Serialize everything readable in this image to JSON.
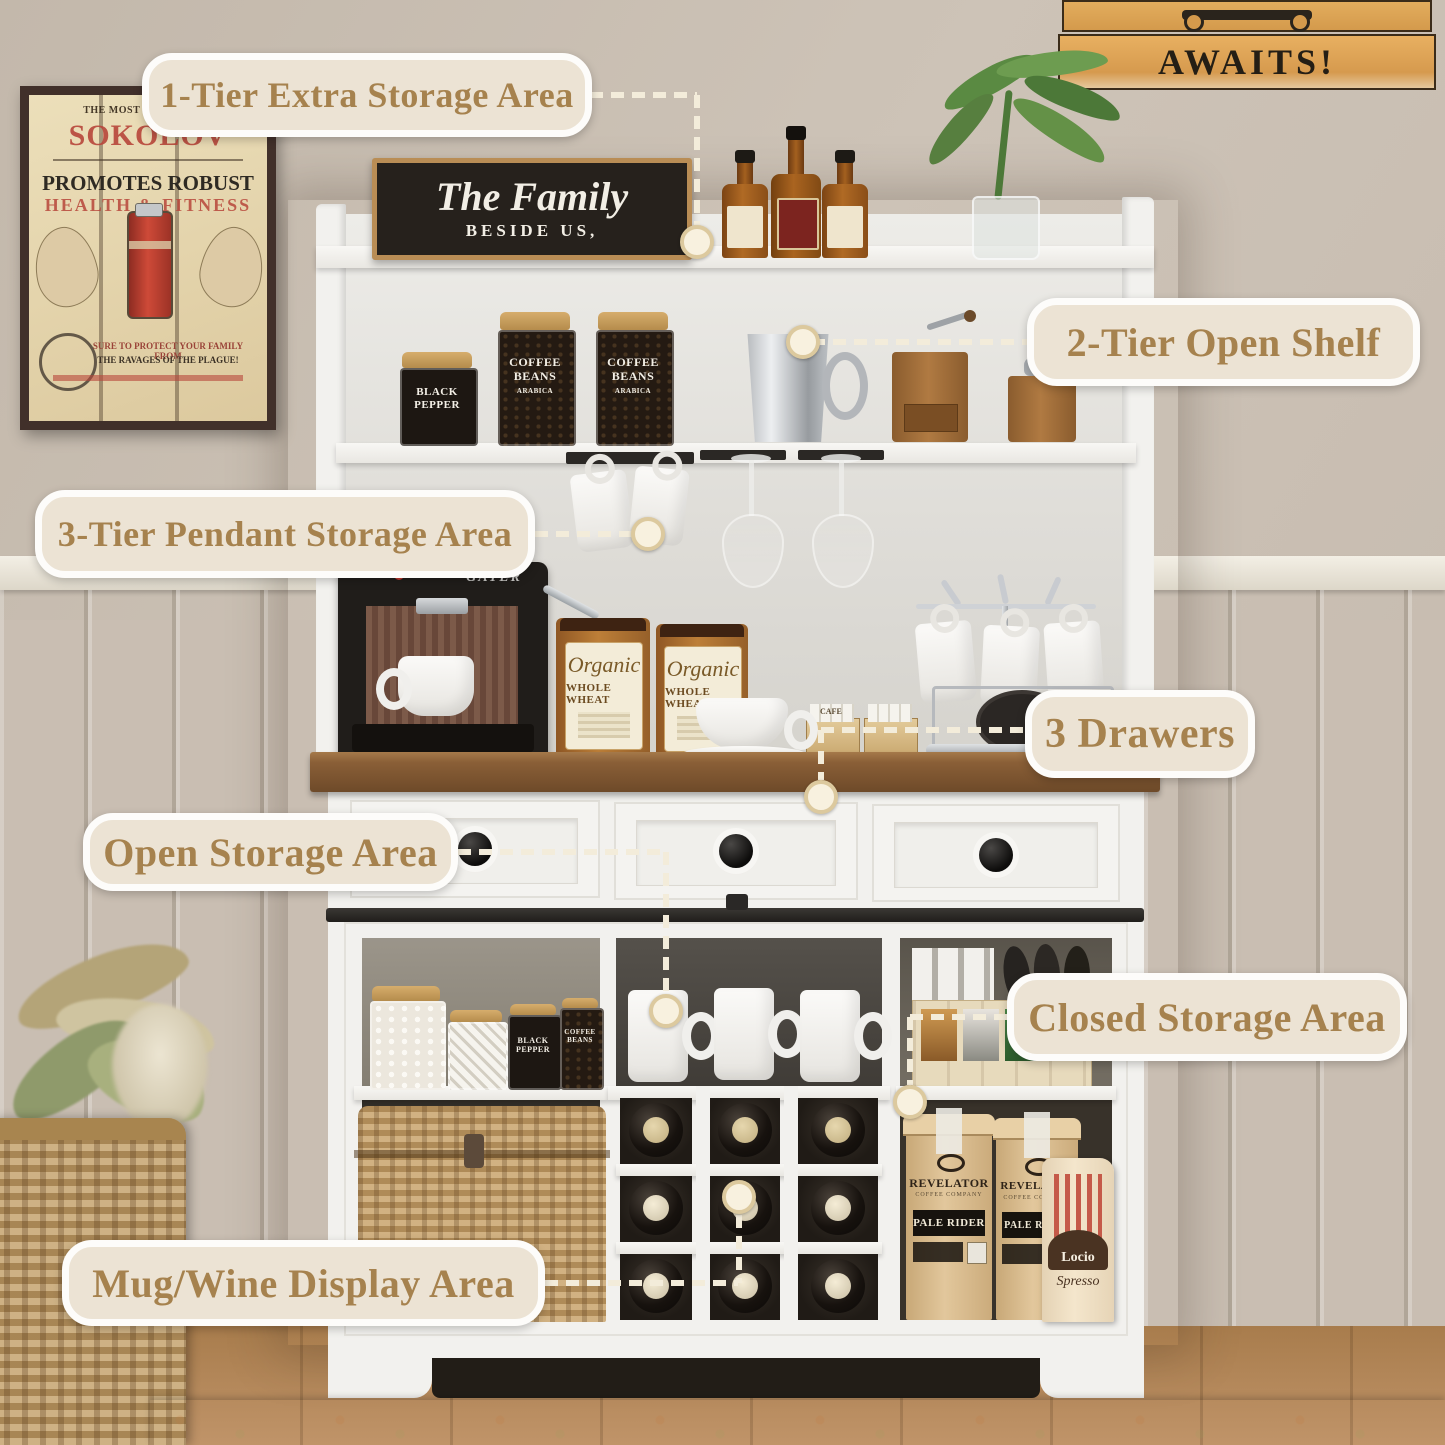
{
  "meta": {
    "description": "Annotated product photo of a white farmhouse coffee bar cabinet / buffet hutch with feature callouts"
  },
  "colors": {
    "pill_bg": "#ece3d4",
    "pill_border": "#fdfcfa",
    "pill_text": "#a6824e",
    "connector": "#f3ecda",
    "countertop": "#7a5330",
    "cabinet_white": "#f2f1ee",
    "wall": "#c9beb2",
    "wainscot": "#e9e4d9",
    "floor": "#b98c59"
  },
  "callouts": [
    {
      "label": "1-Tier Extra Storage Area",
      "pill": {
        "x": 142,
        "y": 53,
        "w": 450,
        "h": 84
      },
      "segs": [
        {
          "o": "h",
          "x": 590,
          "y": 95,
          "len": 107
        },
        {
          "o": "v",
          "x": 697,
          "y": 95,
          "len": 130
        }
      ],
      "end": {
        "x": 697,
        "y": 242
      }
    },
    {
      "label": "2-Tier Open Shelf",
      "pill": {
        "x": 1027,
        "y": 298,
        "w": 393,
        "h": 88
      },
      "segs": [
        {
          "o": "h",
          "x": 812,
          "y": 342,
          "len": 215
        }
      ],
      "end": {
        "x": 803,
        "y": 342
      }
    },
    {
      "label": "3-Tier Pendant Storage Area",
      "pill": {
        "x": 35,
        "y": 490,
        "w": 500,
        "h": 88
      },
      "segs": [
        {
          "o": "h",
          "x": 535,
          "y": 534,
          "len": 100
        }
      ],
      "end": {
        "x": 648,
        "y": 534
      }
    },
    {
      "label": "3 Drawers",
      "pill": {
        "x": 1025,
        "y": 690,
        "w": 230,
        "h": 88
      },
      "segs": [
        {
          "o": "h",
          "x": 821,
          "y": 730,
          "len": 204
        },
        {
          "o": "v",
          "x": 821,
          "y": 730,
          "len": 50
        }
      ],
      "end": {
        "x": 821,
        "y": 797
      }
    },
    {
      "label": "Open Storage Area",
      "pill": {
        "x": 83,
        "y": 813,
        "w": 375,
        "h": 78
      },
      "segs": [
        {
          "o": "h",
          "x": 458,
          "y": 852,
          "len": 207
        },
        {
          "o": "v",
          "x": 666,
          "y": 852,
          "len": 142
        }
      ],
      "end": {
        "x": 666,
        "y": 1011
      }
    },
    {
      "label": "Closed Storage Area",
      "pill": {
        "x": 1007,
        "y": 973,
        "w": 400,
        "h": 88
      },
      "segs": [
        {
          "o": "h",
          "x": 910,
          "y": 1017,
          "len": 97
        },
        {
          "o": "v",
          "x": 910,
          "y": 1017,
          "len": 68
        }
      ],
      "end": {
        "x": 910,
        "y": 1102
      }
    },
    {
      "label": "Mug/Wine Display Area",
      "pill": {
        "x": 62,
        "y": 1240,
        "w": 483,
        "h": 86
      },
      "segs": [
        {
          "o": "h",
          "x": 545,
          "y": 1283,
          "len": 193
        },
        {
          "o": "v",
          "x": 739,
          "y": 1215,
          "len": 68
        }
      ],
      "end": {
        "x": 739,
        "y": 1197
      }
    }
  ],
  "wall": {
    "poster": {
      "top_line": "THE MOST POPULAR FO",
      "brand": "SOKOLOV",
      "line1": "PROMOTES ROBUST",
      "line2": "HEALTH & FITNESS",
      "bottom1": "SURE TO PROTECT YOUR FAMILY FROM",
      "bottom2": "THE RAVAGES OF THE PLAGUE!"
    },
    "awaits_sign": {
      "text": "AWAITS!"
    }
  },
  "cabinet": {
    "family_sign": {
      "line1": "The Family",
      "line2": "BESIDE US,"
    },
    "labels": {
      "pepper1": "BLACK",
      "pepper2": "PEPPER",
      "coffee1": "COFFEE",
      "coffee2": "BEANS",
      "coffee3": "ARABICA",
      "canister1": "Organic",
      "canister2": "WHOLE WHEAT",
      "machine": "GATER",
      "sugar": "CAFE"
    },
    "bags": {
      "brand": "REVELATOR",
      "sub": "COFFEE COMPANY",
      "name": "PALE RIDER",
      "locio1": "Locio",
      "locio2": "Spresso"
    }
  }
}
